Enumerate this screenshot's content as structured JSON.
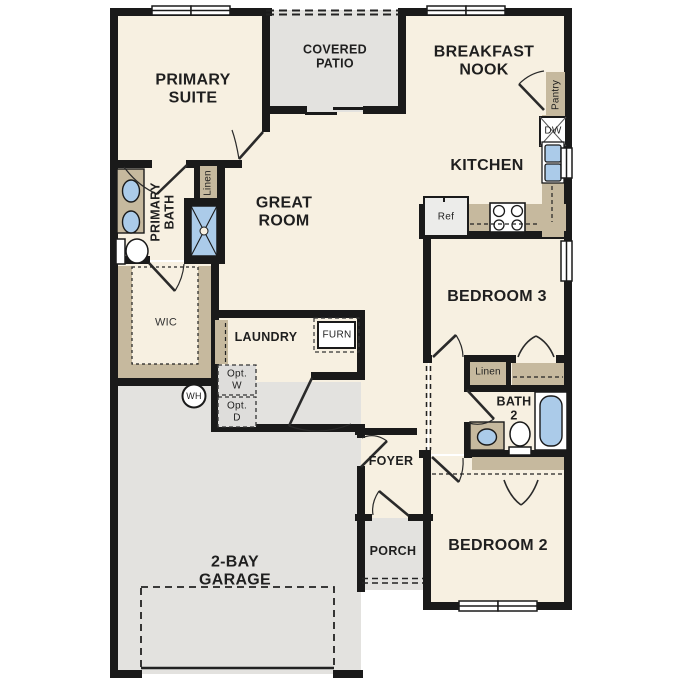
{
  "colors": {
    "wall": "#1a1a1a",
    "interior_floor": "#f7f0e1",
    "exterior_floor": "#e3e2df",
    "cabinetry": "#c6b99e",
    "plumbing_fixture": "#abcbe9"
  },
  "rooms": {
    "primary_suite": "PRIMARY\nSUITE",
    "covered_patio": "COVERED\nPATIO",
    "breakfast_nook": "BREAKFAST\nNOOK",
    "kitchen": "KITCHEN",
    "great_room": "GREAT\nROOM",
    "primary_bath": "PRIMARY\nBATH",
    "wic": "WIC",
    "laundry": "LAUNDRY",
    "garage": "2-BAY\nGARAGE",
    "foyer": "FOYER",
    "porch": "PORCH",
    "bedroom3": "BEDROOM 3",
    "bath2": "BATH\n2",
    "bedroom2": "BEDROOM 2"
  },
  "closets": {
    "linen_primary": "Linen",
    "linen_hall": "Linen",
    "pantry": "Pantry"
  },
  "appliances": {
    "furnace": "FURN",
    "opt_washer": "Opt.\nW",
    "opt_dryer": "Opt.\nD",
    "water_heater": "WH",
    "refrigerator": "Ref",
    "dishwasher": "DW"
  }
}
